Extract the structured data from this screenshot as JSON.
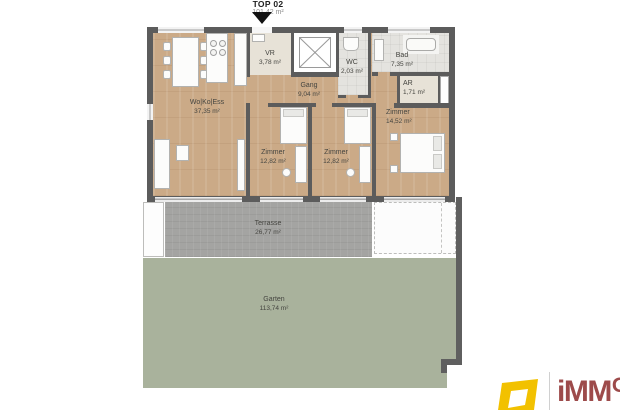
{
  "title": {
    "name": "TOP 02",
    "area": "101,42 m²"
  },
  "rooms": {
    "wokoess": {
      "name": "Wo|Ko|Ess",
      "area": "37,35 m²"
    },
    "vr": {
      "name": "VR",
      "area": "3,78 m²"
    },
    "wc": {
      "name": "WC",
      "area": "2,03 m²"
    },
    "bad": {
      "name": "Bad",
      "area": "7,35 m²"
    },
    "gang": {
      "name": "Gang",
      "area": "9,04 m²"
    },
    "ar": {
      "name": "AR",
      "area": "1,71 m²"
    },
    "zimmer_left": {
      "name": "Zimmer",
      "area": "12,82 m²"
    },
    "zimmer_middle": {
      "name": "Zimmer",
      "area": "12,82 m²"
    },
    "zimmer_right": {
      "name": "Zimmer",
      "area": "14,52 m²"
    },
    "terrasse": {
      "name": "Terrasse",
      "area": "26,77 m²"
    },
    "garten": {
      "name": "Garten",
      "area": "113,74 m²"
    }
  },
  "icons": {
    "entrance_marker": "triangle-down",
    "elevator_shaft": "x-cross"
  },
  "logo": {
    "brand_main": "iMM",
    "brand_sup": "O"
  },
  "colors": {
    "wall": "#5c5c5c",
    "wood_floor": "#cbaa87",
    "tile_floor": "#e4e3df",
    "vestibule_floor": "#e7e2d7",
    "terrace": "#a4a4a2",
    "garden": "#a9b29c",
    "logo_yellow": "#f2c100",
    "logo_red": "#9d4b4b"
  }
}
